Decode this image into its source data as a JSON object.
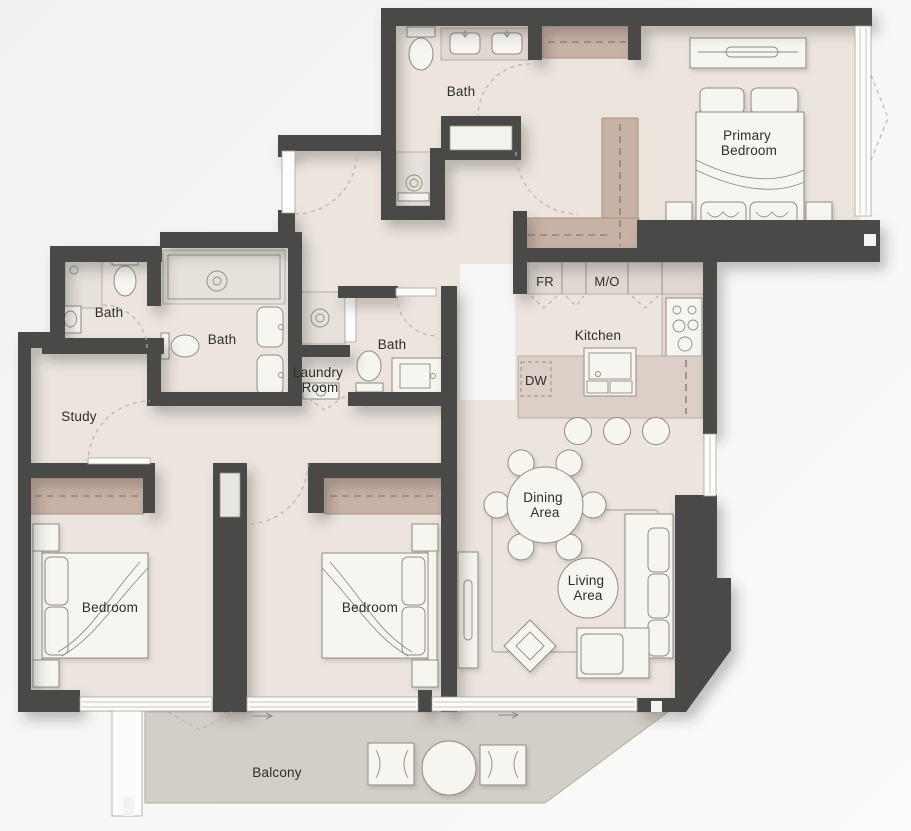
{
  "plan": {
    "labels": {
      "bath_top": "Bath",
      "bath_left": "Bath",
      "bath_mid": "Bath",
      "bath_inner": "Bath",
      "primary_1": "Primary",
      "primary_2": "Bedroom",
      "kitchen": "Kitchen",
      "fr": "FR",
      "mo": "M/O",
      "dw": "DW",
      "study": "Study",
      "laundry_1": "Laundry",
      "laundry_2": "Room",
      "bedroom_left": "Bedroom",
      "bedroom_right": "Bedroom",
      "dining_1": "Dining",
      "dining_2": "Area",
      "living_1": "Living",
      "living_2": "Area",
      "balcony": "Balcony"
    },
    "colors": {
      "wall": "#4a4947",
      "floor": "#ebe5dd",
      "balcony_floor": "#d4cfc6",
      "wardrobe": "#c8b2a5",
      "counter": "#dccfc8",
      "furniture": "#f7f5f0",
      "outline": "#8f8b83",
      "text": "#2d2d2c",
      "background": "#f4f3f2"
    }
  }
}
